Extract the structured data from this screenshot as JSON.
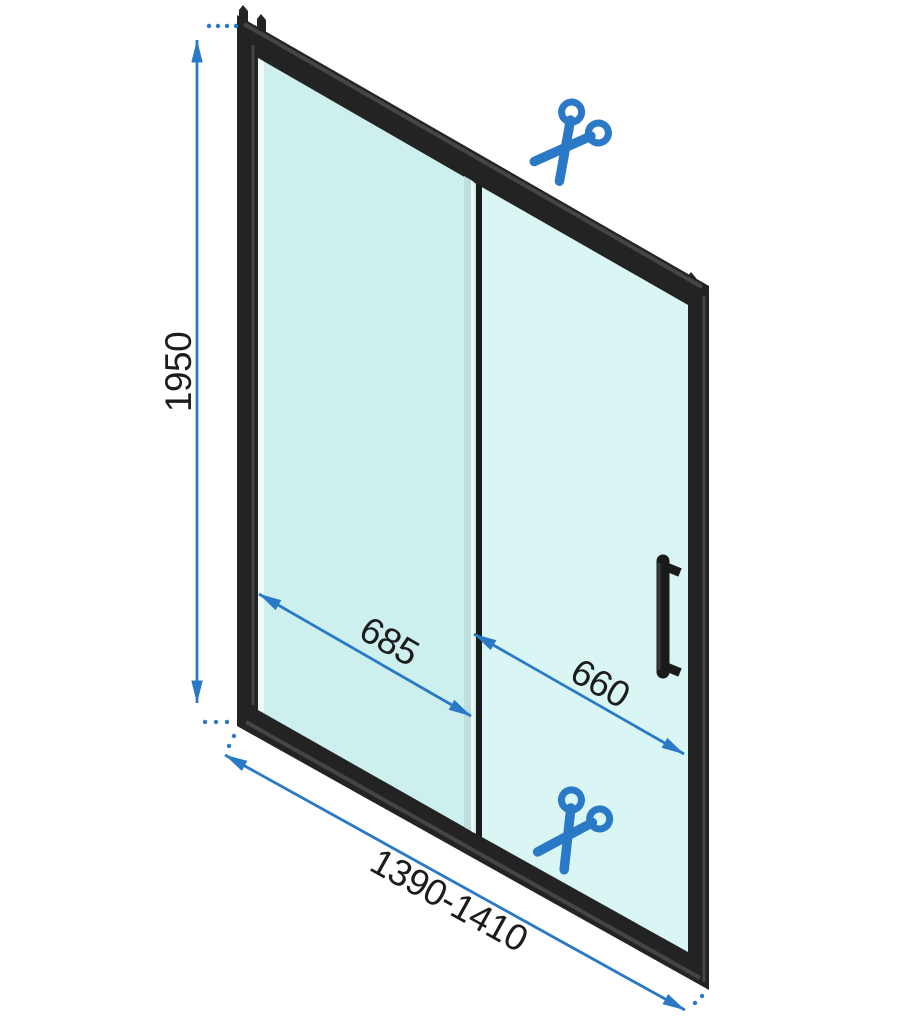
{
  "diagram": {
    "kind": "technical-dimension-drawing",
    "subject": "sliding-shower-door",
    "labels": {
      "height": "1950",
      "left_panel_width": "685",
      "right_panel_width": "660",
      "overall_width": "1390-1410"
    },
    "icons": {
      "top": "scissors-icon",
      "bottom": "scissors-icon"
    },
    "colors": {
      "accent": "#2a79c6",
      "ink": "#1c1c1c",
      "frame": "#232323",
      "frame_highlight": "#454545",
      "glass_left": "#cdf0ee",
      "glass_right": "#d9f6f4",
      "glass_edge": "#bcdfde",
      "background": "#ffffff"
    }
  }
}
